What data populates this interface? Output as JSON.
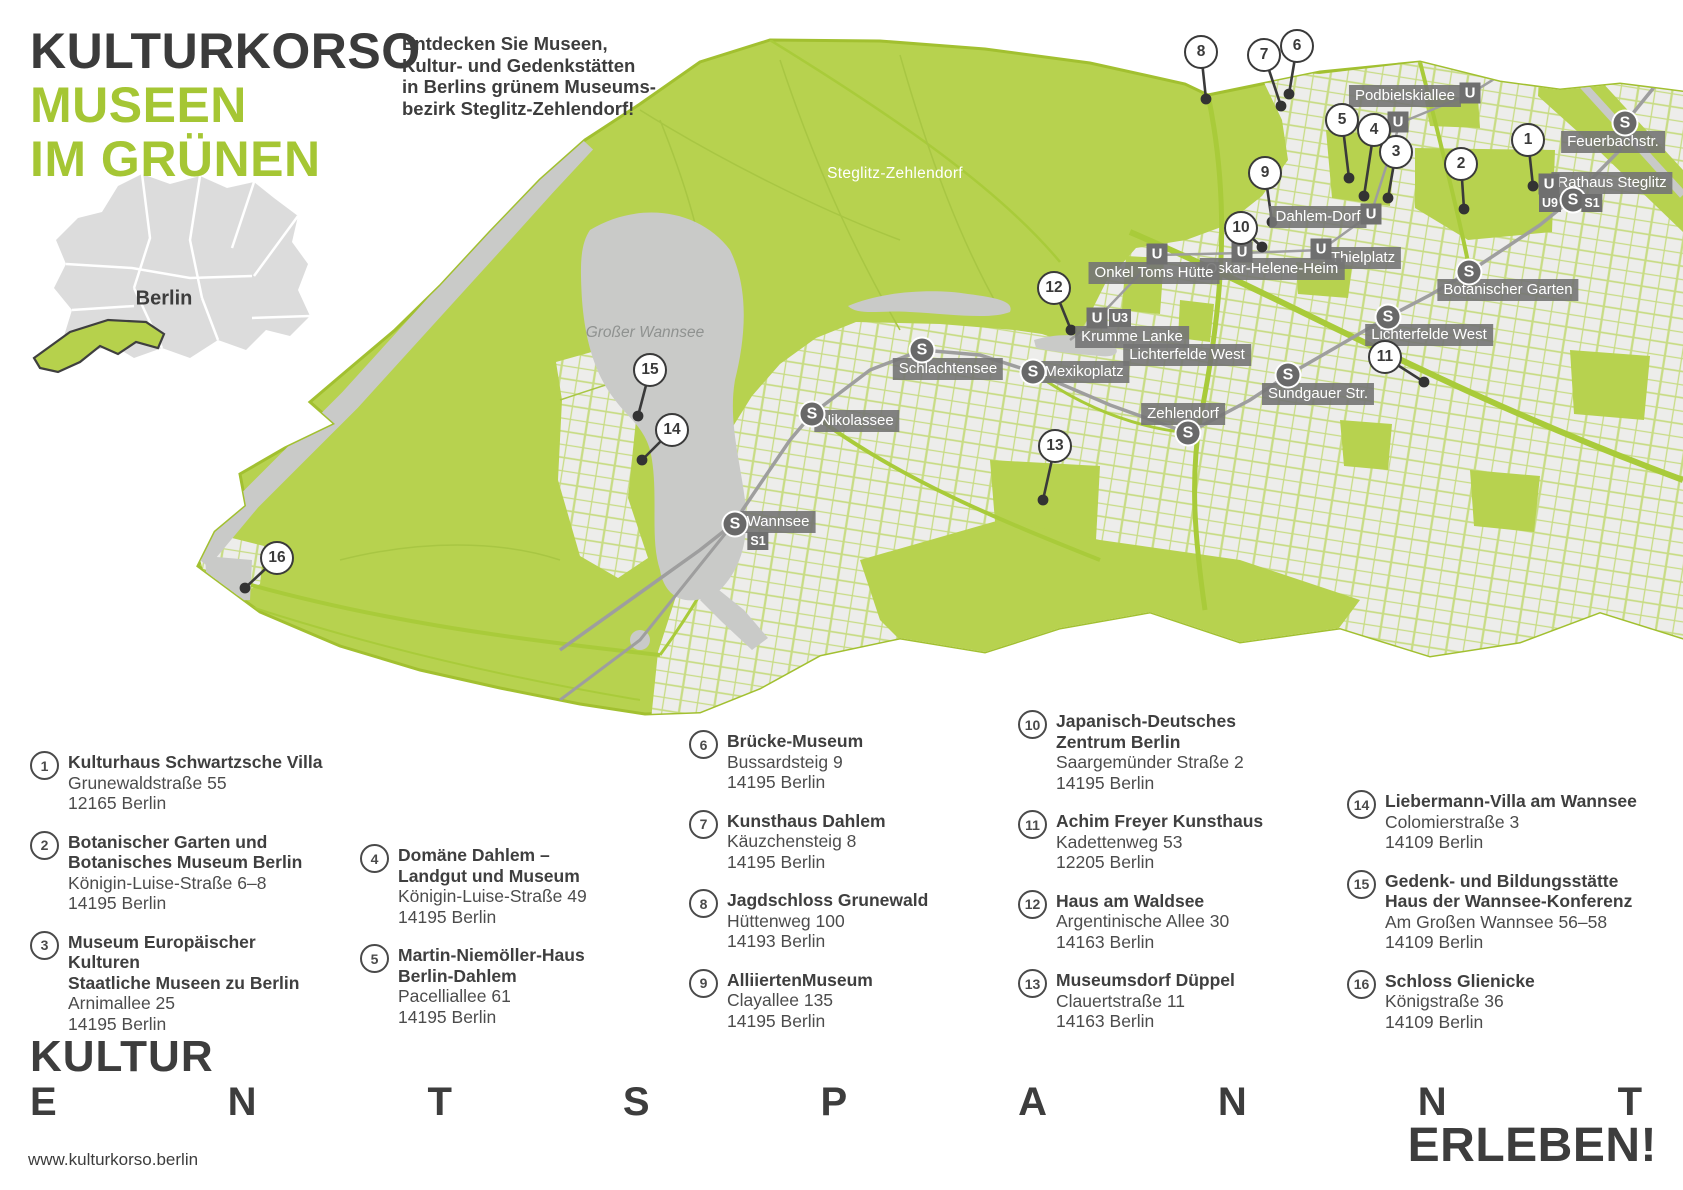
{
  "header": {
    "brand_line1": "KULTURKORSO",
    "brand_line2": "MUSEEN",
    "brand_line3": "IM GRÜNEN",
    "intro": "Entdecken Sie Museen,\nKultur- und Gedenkstätten\nin Berlins grünem Museums-\nbezirk Steglitz-Zehlendorf!"
  },
  "inset": {
    "label": "Berlin"
  },
  "map": {
    "district_label": "Steglitz-Zehlendorf",
    "lake_label": "Großer Wannsee",
    "colors": {
      "brand_green": "#a5c634",
      "map_green": "#b7d24f",
      "urban_gray": "#ededeb",
      "water_gray": "#c9cac8",
      "label_gray": "#747474",
      "dark": "#3a3a3a"
    },
    "stations": [
      {
        "name": "Podbielskiallee",
        "label_x": 1405,
        "label_y": 96,
        "icons": [
          {
            "t": "U",
            "x": 1470,
            "y": 93
          },
          {
            "t": "U",
            "x": 1398,
            "y": 122
          }
        ]
      },
      {
        "name": "Dahlem-Dorf",
        "label_x": 1318,
        "label_y": 217,
        "icons": [
          {
            "t": "U",
            "x": 1371,
            "y": 214
          }
        ]
      },
      {
        "name": "Thielplatz",
        "label_x": 1363,
        "label_y": 258,
        "icons": [
          {
            "t": "U",
            "x": 1321,
            "y": 249
          }
        ]
      },
      {
        "name": "Oskar-Helene-Heim",
        "label_x": 1272,
        "label_y": 269,
        "icons": [
          {
            "t": "U",
            "x": 1242,
            "y": 252
          }
        ]
      },
      {
        "name": "Onkel Toms Hütte",
        "label_x": 1154,
        "label_y": 273,
        "icons": [
          {
            "t": "U",
            "x": 1157,
            "y": 254
          }
        ]
      },
      {
        "name": "Krumme Lanke",
        "label_x": 1132,
        "label_y": 337,
        "icons": [
          {
            "t": "U",
            "x": 1097,
            "y": 318
          },
          {
            "t": "U3",
            "x": 1120,
            "y": 318
          }
        ]
      },
      {
        "name": "Lichterfelde West",
        "label_x": 1187,
        "label_y": 355,
        "icons": []
      },
      {
        "name": "Lichterfelde West",
        "label_x": 1429,
        "label_y": 335,
        "icons": [
          {
            "t": "S",
            "x": 1388,
            "y": 317
          }
        ]
      },
      {
        "name": "Botanischer Garten",
        "label_x": 1508,
        "label_y": 290,
        "icons": [
          {
            "t": "S",
            "x": 1469,
            "y": 272
          }
        ]
      },
      {
        "name": "Mexikoplatz",
        "label_x": 1084,
        "label_y": 372,
        "icons": [
          {
            "t": "S",
            "x": 1033,
            "y": 372
          }
        ]
      },
      {
        "name": "Schlachtensee",
        "label_x": 948,
        "label_y": 369,
        "icons": [
          {
            "t": "S",
            "x": 922,
            "y": 350
          }
        ]
      },
      {
        "name": "Nikolassee",
        "label_x": 857,
        "label_y": 421,
        "icons": [
          {
            "t": "S",
            "x": 812,
            "y": 414
          }
        ]
      },
      {
        "name": "Zehlendorf",
        "label_x": 1183,
        "label_y": 414,
        "icons": [
          {
            "t": "S",
            "x": 1188,
            "y": 433
          }
        ]
      },
      {
        "name": "Sundgauer Str.",
        "label_x": 1318,
        "label_y": 394,
        "icons": [
          {
            "t": "S",
            "x": 1288,
            "y": 375
          }
        ]
      },
      {
        "name": "Wannsee",
        "label_x": 778,
        "label_y": 522,
        "icons": [
          {
            "t": "S",
            "x": 735,
            "y": 524
          },
          {
            "t": "S1",
            "x": 758,
            "y": 541
          }
        ]
      },
      {
        "name": "Feuerbachstr.",
        "label_x": 1613,
        "label_y": 142,
        "icons": [
          {
            "t": "S",
            "x": 1625,
            "y": 123
          }
        ]
      },
      {
        "name": "Rathaus Steglitz",
        "label_x": 1612,
        "label_y": 183,
        "icons": [
          {
            "t": "U",
            "x": 1549,
            "y": 184
          },
          {
            "t": "U9",
            "x": 1550,
            "y": 203
          },
          {
            "t": "S",
            "x": 1573,
            "y": 200
          },
          {
            "t": "S1",
            "x": 1592,
            "y": 203
          }
        ]
      }
    ],
    "markers": [
      {
        "n": "1",
        "cx": 1528,
        "cy": 140,
        "dx": 1533,
        "dy": 186
      },
      {
        "n": "2",
        "cx": 1461,
        "cy": 164,
        "dx": 1464,
        "dy": 209
      },
      {
        "n": "3",
        "cx": 1396,
        "cy": 152,
        "dx": 1388,
        "dy": 198
      },
      {
        "n": "4",
        "cx": 1374,
        "cy": 130,
        "dx": 1364,
        "dy": 196
      },
      {
        "n": "5",
        "cx": 1342,
        "cy": 120,
        "dx": 1349,
        "dy": 178
      },
      {
        "n": "6",
        "cx": 1297,
        "cy": 46,
        "dx": 1289,
        "dy": 94
      },
      {
        "n": "7",
        "cx": 1264,
        "cy": 55,
        "dx": 1281,
        "dy": 106
      },
      {
        "n": "8",
        "cx": 1201,
        "cy": 52,
        "dx": 1206,
        "dy": 99
      },
      {
        "n": "9",
        "cx": 1265,
        "cy": 173,
        "dx": 1272,
        "dy": 222
      },
      {
        "n": "10",
        "cx": 1241,
        "cy": 228,
        "dx": 1262,
        "dy": 247
      },
      {
        "n": "11",
        "cx": 1385,
        "cy": 357,
        "dx": 1424,
        "dy": 382
      },
      {
        "n": "12",
        "cx": 1054,
        "cy": 288,
        "dx": 1071,
        "dy": 330
      },
      {
        "n": "13",
        "cx": 1055,
        "cy": 446,
        "dx": 1043,
        "dy": 500
      },
      {
        "n": "14",
        "cx": 672,
        "cy": 430,
        "dx": 642,
        "dy": 460
      },
      {
        "n": "15",
        "cx": 650,
        "cy": 370,
        "dx": 638,
        "dy": 416
      },
      {
        "n": "16",
        "cx": 277,
        "cy": 558,
        "dx": 245,
        "dy": 588
      }
    ]
  },
  "museums": {
    "columns": [
      {
        "x": 30,
        "y": 752,
        "items": [
          {
            "num": "1",
            "title": [
              "Kulturhaus Schwartzsche Villa"
            ],
            "address": [
              "Grunewaldstraße 55",
              "12165 Berlin"
            ]
          },
          {
            "num": "2",
            "title": [
              "Botanischer Garten und",
              "Botanisches Museum Berlin"
            ],
            "address": [
              "Königin-Luise-Straße 6–8",
              "14195 Berlin"
            ]
          },
          {
            "num": "3",
            "title": [
              "Museum Europäischer",
              "Kulturen",
              "Staatliche Museen zu Berlin"
            ],
            "address": [
              "Arnimallee 25",
              "14195 Berlin"
            ]
          }
        ]
      },
      {
        "x": 360,
        "y": 845,
        "items": [
          {
            "num": "4",
            "title": [
              "Domäne Dahlem –",
              "Landgut und Museum"
            ],
            "address": [
              "Königin-Luise-Straße 49",
              "14195 Berlin"
            ]
          },
          {
            "num": "5",
            "title": [
              "Martin-Niemöller-Haus",
              "Berlin-Dahlem"
            ],
            "address": [
              "Pacelliallee 61",
              "14195 Berlin"
            ]
          }
        ]
      },
      {
        "x": 689,
        "y": 731,
        "items": [
          {
            "num": "6",
            "title": [
              "Brücke-Museum"
            ],
            "address": [
              "Bussardsteig 9",
              "14195 Berlin"
            ]
          },
          {
            "num": "7",
            "title": [
              "Kunsthaus Dahlem"
            ],
            "address": [
              "Käuzchensteig 8",
              "14195 Berlin"
            ]
          },
          {
            "num": "8",
            "title": [
              "Jagdschloss Grunewald"
            ],
            "address": [
              "Hüttenweg 100",
              "14193 Berlin"
            ]
          },
          {
            "num": "9",
            "title": [
              "AlliiertenMuseum"
            ],
            "address": [
              "Clayallee 135",
              "14195 Berlin"
            ]
          }
        ]
      },
      {
        "x": 1018,
        "y": 711,
        "items": [
          {
            "num": "10",
            "title": [
              "Japanisch-Deutsches",
              "Zentrum Berlin"
            ],
            "address": [
              "Saargemünder Straße 2",
              "14195 Berlin"
            ]
          },
          {
            "num": "11",
            "title": [
              "Achim Freyer Kunsthaus"
            ],
            "address": [
              "Kadettenweg 53",
              "12205 Berlin"
            ]
          },
          {
            "num": "12",
            "title": [
              "Haus am Waldsee"
            ],
            "address": [
              "Argentinische Allee 30",
              "14163 Berlin"
            ]
          },
          {
            "num": "13",
            "title": [
              "Museumsdorf Düppel"
            ],
            "address": [
              "Clauertstraße 11",
              "14163 Berlin"
            ]
          }
        ]
      },
      {
        "x": 1347,
        "y": 791,
        "items": [
          {
            "num": "14",
            "title": [
              "Liebermann-Villa am Wannsee"
            ],
            "address": [
              "Colomierstraße 3",
              "14109 Berlin"
            ]
          },
          {
            "num": "15",
            "title": [
              "Gedenk- und Bildungsstätte",
              "Haus der Wannsee-Konferenz"
            ],
            "address": [
              "Am Großen Wannsee 56–58",
              "14109 Berlin"
            ]
          },
          {
            "num": "16",
            "title": [
              "Schloss Glienicke"
            ],
            "address": [
              "Königstraße 36",
              "14109 Berlin"
            ]
          }
        ]
      }
    ]
  },
  "footer": {
    "word1": "KULTUR",
    "spread_letters": [
      "E",
      "N",
      "T",
      "S",
      "P",
      "A",
      "N",
      "N",
      "T"
    ],
    "word2": "ERLEBEN!",
    "url": "www.kulturkorso.berlin"
  }
}
